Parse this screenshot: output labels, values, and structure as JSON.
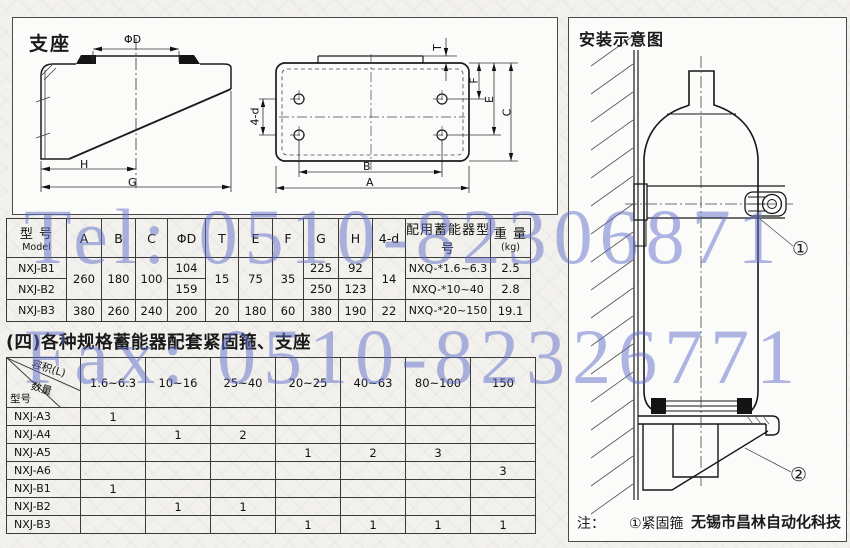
{
  "watermark": {
    "line1": "Tel: 0510-82306871",
    "line2": "Fax: 0510-82326771",
    "color": "#606ec8"
  },
  "drawing": {
    "title": "支座",
    "labels": {
      "phi_d": "ΦD",
      "h": "H",
      "g": "G",
      "a": "A",
      "b": "B",
      "t": "T",
      "f": "F",
      "e": "E",
      "c": "C",
      "d4": "4-d"
    }
  },
  "install": {
    "title": "安装示意图",
    "callout1": "①",
    "callout2": "②",
    "note_prefix": "注：",
    "note_item1": "①紧固箍",
    "note_company": "无锡市昌林自动化科技"
  },
  "table1": {
    "h": {
      "model_cn": "型 号",
      "model_en": "Model",
      "a": "A",
      "b": "B",
      "c": "C",
      "d": "ΦD",
      "t": "T",
      "e": "E",
      "f": "F",
      "g": "G",
      "hh": "H",
      "d4": "4-d",
      "acc": "配用蓄能器型号",
      "wt_cn": "重 量",
      "wt_unit": "(kg)"
    },
    "r1": {
      "model": "NXJ-B1",
      "d": "104",
      "g": "225",
      "hh": "92",
      "acc": "NXQ-*1.6~6.3",
      "wt": "2.5"
    },
    "r12": {
      "a": "260",
      "b": "180",
      "c": "100",
      "t": "15",
      "e": "75",
      "f": "35",
      "d4": "14"
    },
    "r2": {
      "model": "NXJ-B2",
      "d": "159",
      "g": "250",
      "hh": "123",
      "acc": "NXQ-*10~40",
      "wt": "2.8"
    },
    "r3": {
      "model": "NXJ-B3",
      "a": "380",
      "b": "260",
      "c": "240",
      "d": "200",
      "t": "20",
      "e": "180",
      "f": "60",
      "g": "380",
      "hh": "190",
      "d4": "22",
      "acc": "NXQ-*20~150",
      "wt": "19.1"
    }
  },
  "section_title": "(四)各种规格蓄能器配套紧固箍、支座",
  "table2": {
    "corner": {
      "top": "容积(L)",
      "mid": "数量",
      "bottom": "型号"
    },
    "cols": [
      "1.6~6.3",
      "10~16",
      "25~40",
      "20~25",
      "40~63",
      "80~100",
      "150"
    ],
    "rows": [
      {
        "model": "NXJ-A3",
        "c": [
          "1",
          "",
          "",
          "",
          "",
          "",
          ""
        ]
      },
      {
        "model": "NXJ-A4",
        "c": [
          "",
          "1",
          "2",
          "",
          "",
          "",
          ""
        ]
      },
      {
        "model": "NXJ-A5",
        "c": [
          "",
          "",
          "",
          "1",
          "2",
          "3",
          ""
        ]
      },
      {
        "model": "NXJ-A6",
        "c": [
          "",
          "",
          "",
          "",
          "",
          "",
          "3"
        ]
      },
      {
        "model": "NXJ-B1",
        "c": [
          "1",
          "",
          "",
          "",
          "",
          "",
          ""
        ]
      },
      {
        "model": "NXJ-B2",
        "c": [
          "",
          "1",
          "1",
          "",
          "",
          "",
          ""
        ]
      },
      {
        "model": "NXJ-B3",
        "c": [
          "",
          "",
          "",
          "1",
          "1",
          "1",
          "1"
        ]
      }
    ]
  }
}
